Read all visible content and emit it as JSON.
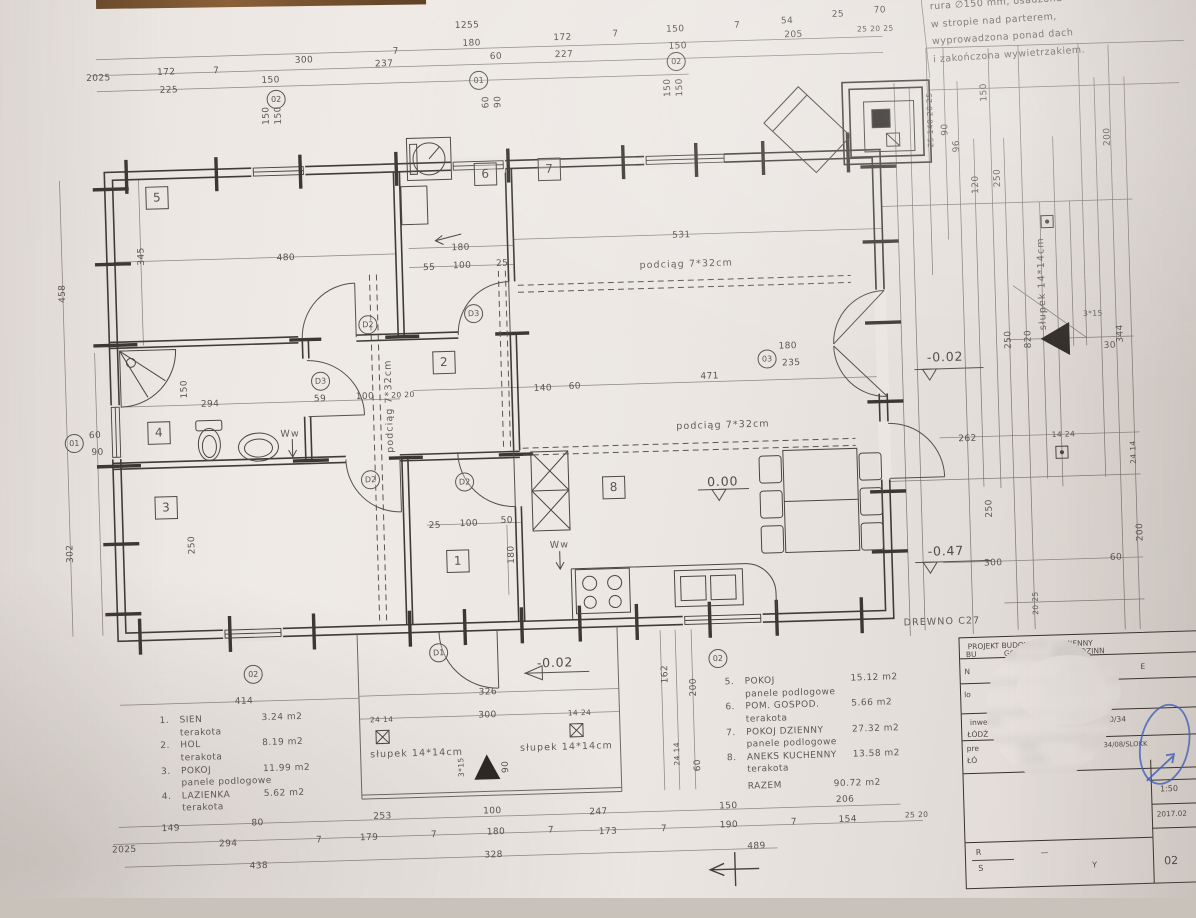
{
  "note_top_right": {
    "lines": [
      "rura ∅150 mm, osadzona",
      "w stropie nad parterem,",
      "wyprowadzona ponad dach",
      "i zakończona wywietrzakiem."
    ]
  },
  "legend_left": {
    "items": [
      {
        "no": "1.",
        "name": "SIEN",
        "area": "3.24  m2",
        "finish": "terakota"
      },
      {
        "no": "2.",
        "name": "HOL",
        "area": "8.19  m2",
        "finish": "terakota"
      },
      {
        "no": "3.",
        "name": "POKOJ",
        "area": "11.99  m2",
        "finish": "panele podlogowe"
      },
      {
        "no": "4.",
        "name": "LAZIENKA",
        "area": "5.62  m2",
        "finish": "terakota"
      }
    ]
  },
  "legend_right": {
    "items": [
      {
        "no": "5.",
        "name": "POKOJ",
        "area": "15.12  m2",
        "finish": "panele podlogowe"
      },
      {
        "no": "6.",
        "name": "POM. GOSPOD.",
        "area": "5.66  m2",
        "finish": "terakota"
      },
      {
        "no": "7.",
        "name": "POKOJ DZIENNY",
        "area": "27.32  m2",
        "finish": "panele podlogowe"
      },
      {
        "no": "8.",
        "name": "ANEKS KUCHENNY",
        "area": "13.58  m2",
        "finish": "terakota"
      }
    ],
    "total_label": "RAZEM",
    "total_value": "90.72  m2"
  },
  "title_block": {
    "row1a": "PROJEKT BUDOWLANY ZAMIENNY",
    "row1b": "BU",
    "row1c": "GO",
    "row1d": "DNORODZINN",
    "row2l": "N",
    "row2a": "DZWOLEWO",
    "row2b": "E",
    "row3l": "lo",
    "row3a": "SKA   Pnr #Z",
    "row4a": "inwentar",
    "row4b": "ŁÓDŹ",
    "row4c": "YSOWSKA 100/34",
    "row5l": "pre",
    "row5b": "ŁÓ",
    "row5m": "RTOS",
    "row5n": "54/403",
    "row5r": "nr upr 34/08/SLOKK",
    "scale": "1:50",
    "date": "2017.02",
    "sheet_no": "02",
    "rys_r": "R",
    "rys_s": "S",
    "rys_dash": "—",
    "rys_y": "Y"
  },
  "plan": {
    "material_note": "DREWNO C27",
    "labels": [
      {
        "t": "1255",
        "x": 480,
        "y": 22
      },
      {
        "t": "300",
        "x": 316,
        "y": 52
      },
      {
        "t": "7",
        "x": 408,
        "y": 46
      },
      {
        "t": "180",
        "x": 484,
        "y": 40
      },
      {
        "t": "54",
        "x": 800,
        "y": 27
      },
      {
        "t": "25",
        "x": 851,
        "y": 22
      },
      {
        "t": "70",
        "x": 893,
        "y": 19
      },
      {
        "t": "2025",
        "x": 110,
        "y": 64
      },
      {
        "t": "172",
        "x": 178,
        "y": 60
      },
      {
        "t": "7",
        "x": 228,
        "y": 60
      },
      {
        "t": "237",
        "x": 396,
        "y": 58
      },
      {
        "t": "60",
        "x": 508,
        "y": 54
      },
      {
        "t": "172",
        "x": 575,
        "y": 37
      },
      {
        "t": "7",
        "x": 628,
        "y": 35
      },
      {
        "t": "150",
        "x": 688,
        "y": 32
      },
      {
        "t": "7",
        "x": 750,
        "y": 30
      },
      {
        "t": "205",
        "x": 806,
        "y": 41
      },
      {
        "t": "25 20 25",
        "x": 888,
        "y": 37,
        "c": "s7"
      },
      {
        "t": "225",
        "x": 180,
        "y": 78
      },
      {
        "t": "150",
        "x": 282,
        "y": 71
      },
      {
        "t": "227",
        "x": 576,
        "y": 54
      },
      {
        "t": "150",
        "x": 690,
        "y": 49
      },
      {
        "t": "150",
        "x": 277,
        "y": 106,
        "r": -90
      },
      {
        "t": "150",
        "x": 289,
        "y": 106,
        "r": -90
      },
      {
        "t": "60",
        "x": 497,
        "y": 99,
        "r": -90
      },
      {
        "t": "90",
        "x": 509,
        "y": 99,
        "r": -90
      },
      {
        "t": "150",
        "x": 679,
        "y": 90,
        "r": -90
      },
      {
        "t": "150",
        "x": 691,
        "y": 90,
        "r": -90
      },
      {
        "t": "90",
        "x": 955,
        "y": 140,
        "r": -90
      },
      {
        "t": "25 140 20 25",
        "x": 940,
        "y": 130,
        "r": -90,
        "c": "s7"
      },
      {
        "t": "150",
        "x": 995,
        "y": 104,
        "r": -90
      },
      {
        "t": "96",
        "x": 966,
        "y": 157,
        "r": -90
      },
      {
        "t": "200",
        "x": 1117,
        "y": 152,
        "r": -90
      },
      {
        "t": "250",
        "x": 1006,
        "y": 190,
        "r": -90
      },
      {
        "t": "120",
        "x": 984,
        "y": 196,
        "r": -90
      },
      {
        "t": "480",
        "x": 292,
        "y": 249
      },
      {
        "t": "180",
        "x": 467,
        "y": 244
      },
      {
        "t": "531",
        "x": 688,
        "y": 238
      },
      {
        "t": "55",
        "x": 435,
        "y": 263
      },
      {
        "t": "100",
        "x": 468,
        "y": 262
      },
      {
        "t": "25",
        "x": 508,
        "y": 261
      },
      {
        "t": "345",
        "x": 148,
        "y": 243,
        "r": -90
      },
      {
        "t": "podciąg  7*32cm",
        "x": 692,
        "y": 267,
        "c": "txt"
      },
      {
        "t": "podciąg  7*32cm",
        "x": 724,
        "y": 429,
        "c": "txt"
      },
      {
        "t": "podciąg  7*32cm",
        "x": 391,
        "y": 400,
        "r": -90,
        "c": "txt"
      },
      {
        "t": "294",
        "x": 212,
        "y": 393
      },
      {
        "t": "59",
        "x": 322,
        "y": 391
      },
      {
        "t": "100",
        "x": 367,
        "y": 390
      },
      {
        "t": "20 20",
        "x": 405,
        "y": 389,
        "c": "s7"
      },
      {
        "t": "140",
        "x": 545,
        "y": 387
      },
      {
        "t": "60",
        "x": 577,
        "y": 386
      },
      {
        "t": "471",
        "x": 712,
        "y": 380
      },
      {
        "t": "180",
        "x": 791,
        "y": 352
      },
      {
        "t": "235",
        "x": 794,
        "y": 369
      },
      {
        "t": "Ww",
        "x": 291,
        "y": 425,
        "c": "txt"
      },
      {
        "t": "150",
        "x": 187,
        "y": 377,
        "r": -90
      },
      {
        "t": "0.00",
        "x": 722,
        "y": 485,
        "c": "big"
      },
      {
        "t": "-0.02",
        "x": 948,
        "y": 367,
        "c": "big"
      },
      {
        "t": "słupek  14*14cm",
        "x": 1047,
        "y": 297,
        "r": -90,
        "c": "txt"
      },
      {
        "t": "3*15",
        "x": 1097,
        "y": 328,
        "c": "s7"
      },
      {
        "t": "30",
        "x": 1113,
        "y": 361
      },
      {
        "t": "344",
        "x": 1124,
        "y": 349,
        "r": -90
      },
      {
        "t": "820",
        "x": 1032,
        "y": 352,
        "r": -90
      },
      {
        "t": "250",
        "x": 1012,
        "y": 352,
        "r": -90
      },
      {
        "t": "262",
        "x": 968,
        "y": 450
      },
      {
        "t": "14 24",
        "x": 1064,
        "y": 448,
        "c": "s7"
      },
      {
        "t": "24 14",
        "x": 1133,
        "y": 468,
        "r": -90,
        "c": "s7"
      },
      {
        "t": "458",
        "x": 68,
        "y": 278,
        "r": -90
      },
      {
        "t": "302",
        "x": 68,
        "y": 538,
        "r": -90
      },
      {
        "t": "250",
        "x": 190,
        "y": 533,
        "r": -90
      },
      {
        "t": "60",
        "x": 96,
        "y": 421
      },
      {
        "t": "90",
        "x": 98,
        "y": 438
      },
      {
        "t": "Ww",
        "x": 557,
        "y": 544,
        "c": "txt"
      },
      {
        "t": "180",
        "x": 509,
        "y": 552,
        "r": -90
      },
      {
        "t": "25",
        "x": 433,
        "y": 521
      },
      {
        "t": "100",
        "x": 467,
        "y": 520
      },
      {
        "t": "50",
        "x": 505,
        "y": 518
      },
      {
        "t": "-0.47",
        "x": 943,
        "y": 561,
        "c": "big"
      },
      {
        "t": "300",
        "x": 990,
        "y": 575
      },
      {
        "t": "60",
        "x": 1113,
        "y": 573
      },
      {
        "t": "200",
        "x": 1138,
        "y": 548,
        "r": -90
      },
      {
        "t": "20 25",
        "x": 1031,
        "y": 616,
        "r": -90,
        "c": "s7"
      },
      {
        "t": "250",
        "x": 988,
        "y": 520,
        "r": -90
      },
      {
        "t": "DREWNO  C27",
        "x": 937,
        "y": 632,
        "c": "txt"
      },
      {
        "t": "-0.02",
        "x": 549,
        "y": 661,
        "c": "big"
      },
      {
        "t": "414",
        "x": 237,
        "y": 691
      },
      {
        "t": "326",
        "x": 481,
        "y": 689
      },
      {
        "t": "24 14",
        "x": 374,
        "y": 713,
        "c": "s7"
      },
      {
        "t": "300",
        "x": 480,
        "y": 712
      },
      {
        "t": "14 24",
        "x": 572,
        "y": 712,
        "c": "s7"
      },
      {
        "t": "słupek  14*14cm",
        "x": 408,
        "y": 748,
        "c": "txt"
      },
      {
        "t": "słupek  14*14cm",
        "x": 558,
        "y": 746,
        "c": "txt"
      },
      {
        "t": "3*15",
        "x": 452,
        "y": 763,
        "r": -90,
        "c": "s7"
      },
      {
        "t": "90",
        "x": 497,
        "y": 764,
        "r": -90
      },
      {
        "t": "162",
        "x": 659,
        "y": 676,
        "r": -90
      },
      {
        "t": "200",
        "x": 687,
        "y": 690,
        "r": -90
      },
      {
        "t": "60",
        "x": 689,
        "y": 768,
        "r": -90
      },
      {
        "t": "24 14",
        "x": 668,
        "y": 756,
        "r": -90,
        "c": "s7"
      },
      {
        "t": "149",
        "x": 160,
        "y": 816
      },
      {
        "t": "80",
        "x": 247,
        "y": 813
      },
      {
        "t": "253",
        "x": 372,
        "y": 810
      },
      {
        "t": "100",
        "x": 482,
        "y": 808
      },
      {
        "t": "247",
        "x": 588,
        "y": 812
      },
      {
        "t": "150",
        "x": 718,
        "y": 810
      },
      {
        "t": "206",
        "x": 835,
        "y": 807
      },
      {
        "t": "2025",
        "x": 113,
        "y": 836
      },
      {
        "t": "294",
        "x": 217,
        "y": 833
      },
      {
        "t": "7",
        "x": 308,
        "y": 832
      },
      {
        "t": "179",
        "x": 358,
        "y": 831
      },
      {
        "t": "7",
        "x": 423,
        "y": 830
      },
      {
        "t": "180",
        "x": 485,
        "y": 829
      },
      {
        "t": "7",
        "x": 540,
        "y": 829
      },
      {
        "t": "173",
        "x": 597,
        "y": 832
      },
      {
        "t": "7",
        "x": 653,
        "y": 831
      },
      {
        "t": "190",
        "x": 718,
        "y": 829
      },
      {
        "t": "7",
        "x": 783,
        "y": 828
      },
      {
        "t": "154",
        "x": 837,
        "y": 827
      },
      {
        "t": "25 20",
        "x": 906,
        "y": 824,
        "c": "s7"
      },
      {
        "t": "438",
        "x": 247,
        "y": 856
      },
      {
        "t": "328",
        "x": 482,
        "y": 852
      },
      {
        "t": "489",
        "x": 745,
        "y": 851
      },
      {
        "t": "01",
        "x": 490,
        "y": 77,
        "c": "circ"
      },
      {
        "t": "02",
        "x": 287,
        "y": 90,
        "c": "circ"
      },
      {
        "t": "02",
        "x": 688,
        "y": 64,
        "c": "circ"
      },
      {
        "t": "01",
        "x": 75,
        "y": 428,
        "c": "circ"
      },
      {
        "t": "02",
        "x": 247,
        "y": 664,
        "c": "circ"
      },
      {
        "t": "02",
        "x": 712,
        "y": 662,
        "c": "circ"
      },
      {
        "t": "03",
        "x": 770,
        "y": 364,
        "c": "circ"
      },
      {
        "t": "D1",
        "x": 433,
        "y": 648,
        "c": "circ"
      },
      {
        "t": "D2",
        "x": 372,
        "y": 318,
        "c": "circ"
      },
      {
        "t": "D2",
        "x": 370,
        "y": 473,
        "c": "circ"
      },
      {
        "t": "D2",
        "x": 464,
        "y": 478,
        "c": "circ"
      },
      {
        "t": "D3",
        "x": 323,
        "y": 373,
        "c": "circ"
      },
      {
        "t": "D3",
        "x": 478,
        "y": 310,
        "c": "circ"
      },
      {
        "t": "5",
        "x": 165,
        "y": 185,
        "c": "room"
      },
      {
        "t": "6",
        "x": 494,
        "y": 171,
        "c": "room"
      },
      {
        "t": "7",
        "x": 558,
        "y": 168,
        "c": "room"
      },
      {
        "t": "2",
        "x": 447,
        "y": 358,
        "c": "room"
      },
      {
        "t": "4",
        "x": 160,
        "y": 420,
        "c": "room"
      },
      {
        "t": "3",
        "x": 165,
        "y": 495,
        "c": "room"
      },
      {
        "t": "1",
        "x": 455,
        "y": 557,
        "c": "room"
      },
      {
        "t": "8",
        "x": 613,
        "y": 488,
        "c": "room"
      }
    ]
  }
}
